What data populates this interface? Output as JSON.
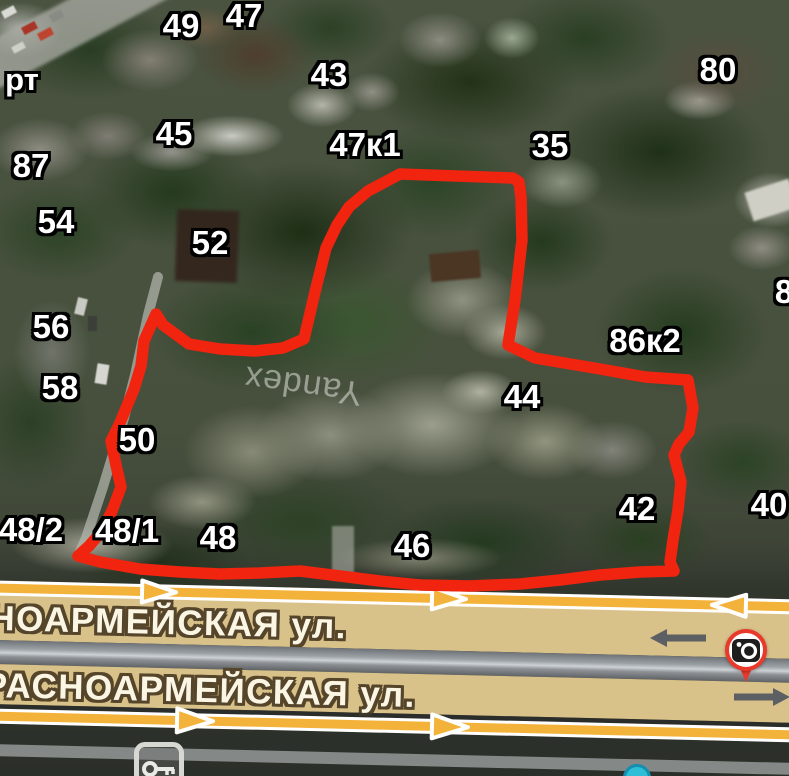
{
  "map": {
    "watermark": "Yandex",
    "corner_label": "рт",
    "labels": [
      {
        "t": "49",
        "x": 181,
        "y": 26
      },
      {
        "t": "47",
        "x": 244,
        "y": 16
      },
      {
        "t": "43",
        "x": 329,
        "y": 75
      },
      {
        "t": "80",
        "x": 718,
        "y": 70
      },
      {
        "t": "45",
        "x": 174,
        "y": 134
      },
      {
        "t": "47к1",
        "x": 365,
        "y": 145
      },
      {
        "t": "35",
        "x": 550,
        "y": 146
      },
      {
        "t": "87",
        "x": 31,
        "y": 166
      },
      {
        "t": "54",
        "x": 56,
        "y": 222
      },
      {
        "t": "52",
        "x": 210,
        "y": 243
      },
      {
        "t": "56",
        "x": 51,
        "y": 327
      },
      {
        "t": "86к2",
        "x": 645,
        "y": 341
      },
      {
        "t": "58",
        "x": 60,
        "y": 388
      },
      {
        "t": "44",
        "x": 522,
        "y": 397
      },
      {
        "t": "50",
        "x": 137,
        "y": 440
      },
      {
        "t": "8",
        "x": 784,
        "y": 292
      },
      {
        "t": "40",
        "x": 769,
        "y": 505
      },
      {
        "t": "42",
        "x": 637,
        "y": 509
      },
      {
        "t": "48/2",
        "x": 31,
        "y": 530
      },
      {
        "t": "48/1",
        "x": 127,
        "y": 531
      },
      {
        "t": "48",
        "x": 218,
        "y": 538
      },
      {
        "t": "46",
        "x": 412,
        "y": 546
      }
    ],
    "streets": {
      "band1": "НОАРМЕЙСКАЯ ул.",
      "band2": "РАСНОАРМЕЙСКАЯ ул."
    },
    "colors": {
      "selection_outline": "#f0240f",
      "road_arrow_yellow": "#f3b23a",
      "street_band_tan": "#d9c18a",
      "street_text": "#fbf5e4",
      "street_text_outline": "#55452a",
      "house_label_fill": "#ffffff",
      "house_label_outline": "#000000",
      "camera_pin_ring": "#e8392b",
      "poi_dot_teal": "#2ebfd6"
    }
  }
}
